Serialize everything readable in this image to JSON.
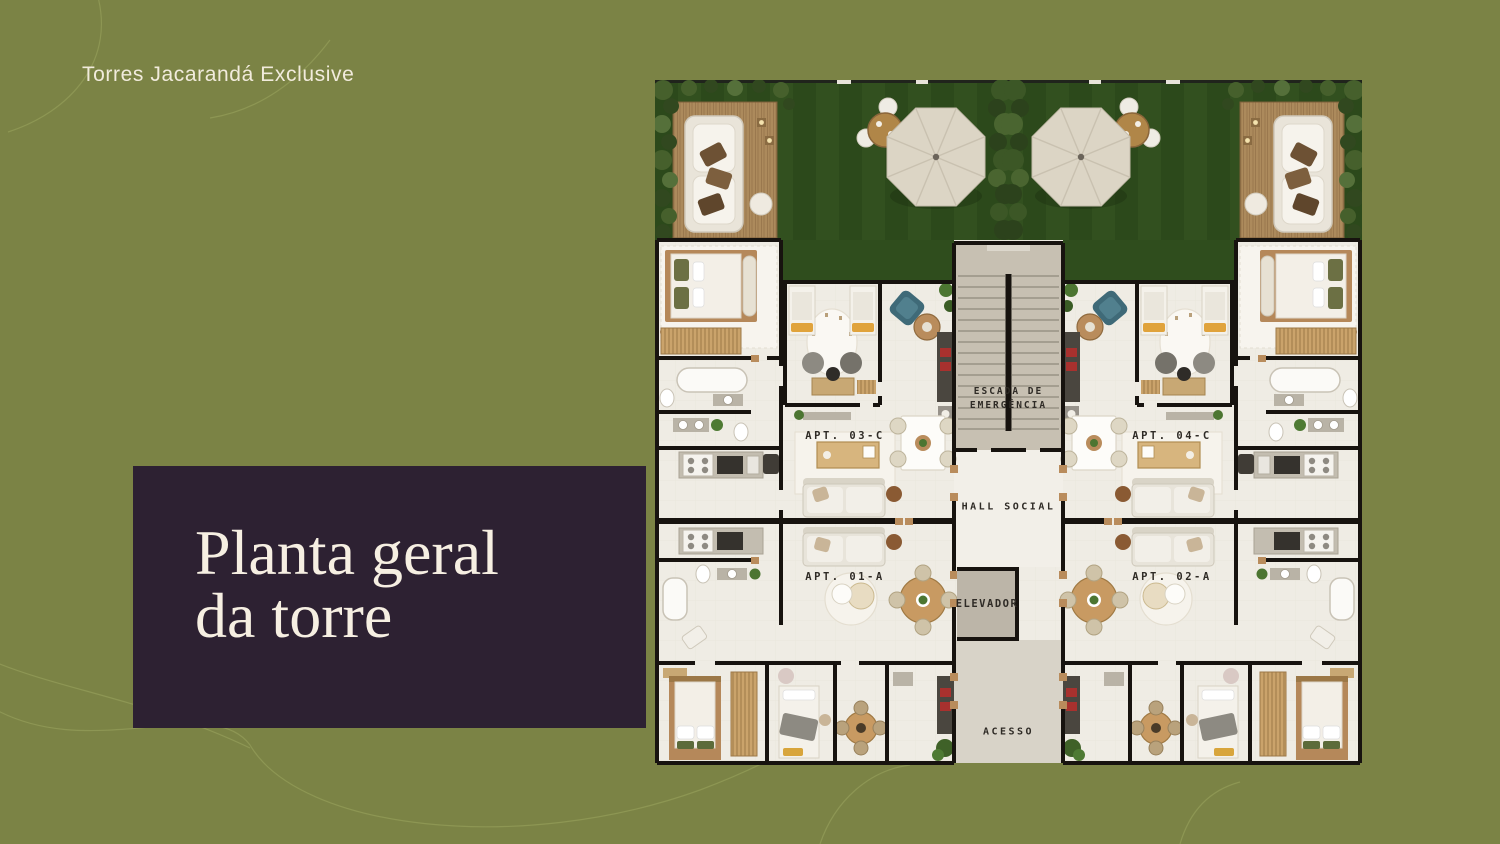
{
  "palette": {
    "background": "#7b8345",
    "panel": "#2d2132",
    "cream_text": "#f6efe2",
    "lawn_green": "#2e4c1c",
    "floor": "#efece4",
    "wall": "#17130f"
  },
  "header": {
    "brand": "Torres Jacarandá Exclusive"
  },
  "title": {
    "line1": "Planta geral",
    "line2": "da torre"
  },
  "floor_plan": {
    "core_labels": {
      "stairs_line1": "ESCADA DE",
      "stairs_line2": "EMERGÊNCIA",
      "hall": "HALL SOCIAL",
      "elevator": "ELEVADOR",
      "access": "ACESSO"
    },
    "apartments": [
      {
        "id": "apt-03c",
        "label": "APT. 03-C"
      },
      {
        "id": "apt-04c",
        "label": "APT. 04-C"
      },
      {
        "id": "apt-01a",
        "label": "APT. 01-A"
      },
      {
        "id": "apt-02a",
        "label": "APT. 02-A"
      }
    ]
  }
}
